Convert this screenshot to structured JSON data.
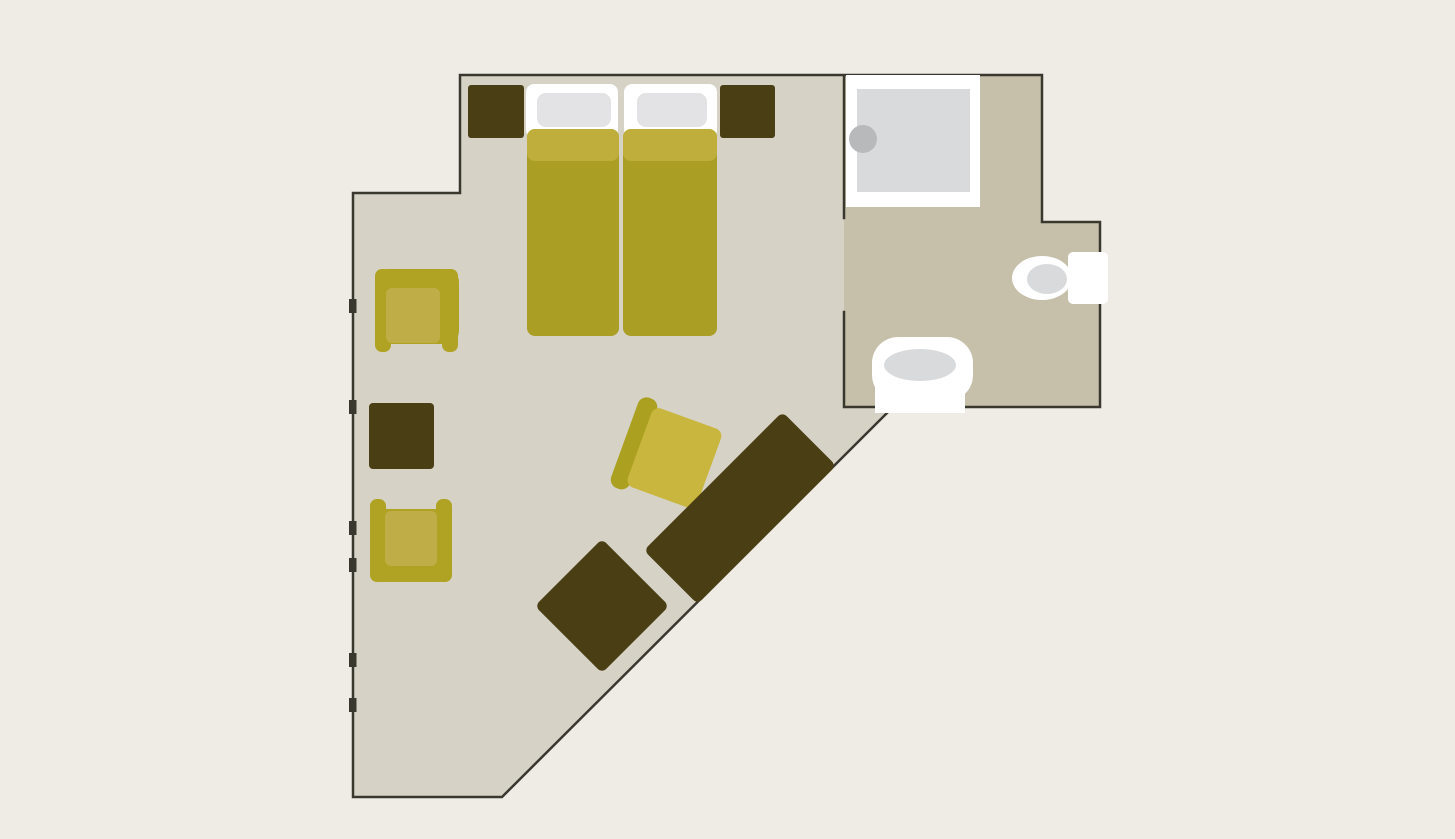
{
  "canvas": {
    "width": 1455,
    "height": 839
  },
  "colors": {
    "background": "#eeece5",
    "room_floor": "#d6d2c6",
    "bathroom_floor": "#c6c0ab",
    "wall": "#3a382e",
    "dark_furniture": "#4a3e14",
    "mustard": "#aa9e24",
    "mustard_light": "#bfae3c",
    "chair_outer": "#b0a323",
    "chair_seat": "#bfae47",
    "chair_band": "#aba01f",
    "chair_seat_bright": "#c9b63e",
    "white": "#ffffff",
    "pillow": "#e3e3e5",
    "fixture_gray": "#d9dadb",
    "drain_gray": "#b8b9bb"
  },
  "shapes": [
    {
      "name": "bedroom-floor",
      "kind": "polygon",
      "fill": "room_floor",
      "attrs": {
        "points": "460,75 844,75 844,407 893,407 502,797 353,797 353,193 460,193"
      }
    },
    {
      "name": "bathroom-floor",
      "kind": "polygon",
      "fill": "bathroom_floor",
      "attrs": {
        "points": "844,75 1042,75 1042,222 1100,222 1100,407 844,407"
      }
    },
    {
      "name": "walls",
      "kind": "path",
      "fill": "none",
      "stroke": "wall",
      "attrs": {
        "d": "M460,75 H1042 M1042,75 V222 H1100 V407 H844 M893,407 L502,797 H353 V193 H460 V75 M844,75 V218 M844,312 V407",
        "stroke-width": "2.5",
        "stroke-linecap": "square"
      }
    },
    {
      "name": "window-tick",
      "kind": "rect",
      "fill": "wall",
      "attrs": {
        "x": "349",
        "y": "299",
        "width": "7.5",
        "height": "14"
      }
    },
    {
      "name": "window-tick",
      "kind": "rect",
      "fill": "wall",
      "attrs": {
        "x": "349",
        "y": "400",
        "width": "7.5",
        "height": "14"
      }
    },
    {
      "name": "window-tick",
      "kind": "rect",
      "fill": "wall",
      "attrs": {
        "x": "349",
        "y": "521",
        "width": "7.5",
        "height": "14"
      }
    },
    {
      "name": "window-tick",
      "kind": "rect",
      "fill": "wall",
      "attrs": {
        "x": "349",
        "y": "558",
        "width": "7.5",
        "height": "14"
      }
    },
    {
      "name": "window-tick",
      "kind": "rect",
      "fill": "wall",
      "attrs": {
        "x": "349",
        "y": "653",
        "width": "7.5",
        "height": "14"
      }
    },
    {
      "name": "window-tick",
      "kind": "rect",
      "fill": "wall",
      "attrs": {
        "x": "349",
        "y": "698",
        "width": "7.5",
        "height": "14"
      }
    },
    {
      "name": "bed-frame-left",
      "kind": "rect",
      "fill": "white",
      "attrs": {
        "x": "526",
        "y": "84",
        "width": "92",
        "height": "54",
        "rx": "8"
      }
    },
    {
      "name": "bed-frame-right",
      "kind": "rect",
      "fill": "white",
      "attrs": {
        "x": "624",
        "y": "84",
        "width": "93",
        "height": "54",
        "rx": "8"
      }
    },
    {
      "name": "pillow-left",
      "kind": "rect",
      "fill": "pillow",
      "attrs": {
        "x": "537",
        "y": "93",
        "width": "74",
        "height": "34",
        "rx": "9"
      }
    },
    {
      "name": "pillow-right",
      "kind": "rect",
      "fill": "pillow",
      "attrs": {
        "x": "637",
        "y": "93",
        "width": "70",
        "height": "34",
        "rx": "9"
      }
    },
    {
      "name": "mattress-left",
      "kind": "rect",
      "fill": "mustard",
      "attrs": {
        "x": "527",
        "y": "129",
        "width": "92",
        "height": "207",
        "rx": "8"
      }
    },
    {
      "name": "mattress-right",
      "kind": "rect",
      "fill": "mustard",
      "attrs": {
        "x": "623",
        "y": "129",
        "width": "94",
        "height": "207",
        "rx": "8"
      }
    },
    {
      "name": "duvet-fold-left",
      "kind": "rect",
      "fill": "mustard_light",
      "attrs": {
        "x": "527",
        "y": "129",
        "width": "92",
        "height": "32",
        "rx": "8"
      }
    },
    {
      "name": "duvet-fold-right",
      "kind": "rect",
      "fill": "mustard_light",
      "attrs": {
        "x": "623",
        "y": "129",
        "width": "94",
        "height": "32",
        "rx": "8"
      }
    },
    {
      "name": "nightstand-left",
      "kind": "rect",
      "fill": "dark_furniture",
      "attrs": {
        "x": "468",
        "y": "85",
        "width": "56",
        "height": "53",
        "rx": "3"
      }
    },
    {
      "name": "nightstand-right",
      "kind": "rect",
      "fill": "dark_furniture",
      "attrs": {
        "x": "720",
        "y": "85",
        "width": "55",
        "height": "53",
        "rx": "3"
      }
    },
    {
      "name": "armchair-top",
      "kind": "group",
      "children": [
        {
          "name": "armchair-back",
          "kind": "rect",
          "fill": "chair_outer",
          "attrs": {
            "x": "375",
            "y": "269",
            "width": "84",
            "height": "75",
            "rx": "13"
          }
        },
        {
          "name": "armchair-arm-left",
          "kind": "rect",
          "fill": "chair_outer",
          "attrs": {
            "x": "375",
            "y": "269",
            "width": "16",
            "height": "83",
            "rx": "7"
          }
        },
        {
          "name": "armchair-arm-right",
          "kind": "rect",
          "fill": "chair_outer",
          "attrs": {
            "x": "442",
            "y": "269",
            "width": "16",
            "height": "83",
            "rx": "7"
          }
        },
        {
          "name": "armchair-seat",
          "kind": "rect",
          "fill": "chair_seat",
          "attrs": {
            "x": "386",
            "y": "288",
            "width": "54",
            "height": "55",
            "rx": "6"
          }
        }
      ]
    },
    {
      "name": "coffee-table",
      "kind": "rect",
      "fill": "dark_furniture",
      "attrs": {
        "x": "369",
        "y": "403",
        "width": "65",
        "height": "66",
        "rx": "4"
      }
    },
    {
      "name": "armchair-bottom",
      "kind": "group",
      "children": [
        {
          "name": "armchair-back",
          "kind": "rect",
          "fill": "chair_outer",
          "attrs": {
            "x": "370",
            "y": "509",
            "width": "82",
            "height": "73",
            "rx": "13"
          }
        },
        {
          "name": "armchair-arm-left",
          "kind": "rect",
          "fill": "chair_outer",
          "attrs": {
            "x": "370",
            "y": "499",
            "width": "16",
            "height": "83",
            "rx": "7"
          }
        },
        {
          "name": "armchair-arm-right",
          "kind": "rect",
          "fill": "chair_outer",
          "attrs": {
            "x": "436",
            "y": "499",
            "width": "16",
            "height": "83",
            "rx": "7"
          }
        },
        {
          "name": "armchair-seat",
          "kind": "rect",
          "fill": "chair_seat",
          "attrs": {
            "x": "385",
            "y": "511",
            "width": "52",
            "height": "55",
            "rx": "6"
          }
        }
      ]
    },
    {
      "name": "lounge-chair",
      "kind": "group",
      "transform": "rotate(20 666 455)",
      "children": [
        {
          "name": "lounge-chair-back",
          "kind": "rect",
          "fill": "chair_band",
          "attrs": {
            "x": "622",
            "y": "407",
            "width": "20",
            "height": "96",
            "rx": "9"
          }
        },
        {
          "name": "lounge-chair-seat",
          "kind": "rect",
          "fill": "chair_seat_bright",
          "attrs": {
            "x": "638",
            "y": "413",
            "width": "74",
            "height": "84",
            "rx": "8"
          }
        }
      ]
    },
    {
      "name": "ottoman",
      "kind": "rect",
      "fill": "dark_furniture",
      "transform": "rotate(45 602 606)",
      "attrs": {
        "x": "554.5",
        "y": "558.5",
        "width": "95",
        "height": "95",
        "rx": "6"
      }
    },
    {
      "name": "sofa",
      "kind": "rect",
      "fill": "dark_furniture",
      "transform": "rotate(-45 740 508)",
      "attrs": {
        "x": "642",
        "y": "470",
        "width": "196",
        "height": "76",
        "rx": "6"
      }
    },
    {
      "name": "shower-tray",
      "kind": "rect",
      "fill": "white",
      "attrs": {
        "x": "846",
        "y": "75",
        "width": "134",
        "height": "132"
      }
    },
    {
      "name": "shower-inner",
      "kind": "rect",
      "fill": "fixture_gray",
      "attrs": {
        "x": "857",
        "y": "89",
        "width": "113",
        "height": "103"
      }
    },
    {
      "name": "shower-drain",
      "kind": "circle",
      "fill": "drain_gray",
      "attrs": {
        "cx": "863",
        "cy": "139",
        "r": "14"
      }
    },
    {
      "name": "toilet-tank",
      "kind": "rect",
      "fill": "white",
      "attrs": {
        "x": "1068",
        "y": "252",
        "width": "40",
        "height": "52",
        "rx": "5"
      }
    },
    {
      "name": "toilet-bowl",
      "kind": "ellipse",
      "fill": "white",
      "attrs": {
        "cx": "1042",
        "cy": "278",
        "rx": "30",
        "ry": "22"
      }
    },
    {
      "name": "toilet-seat",
      "kind": "ellipse",
      "fill": "fixture_gray",
      "attrs": {
        "cx": "1047",
        "cy": "279",
        "rx": "20",
        "ry": "15"
      }
    },
    {
      "name": "sink-pedestal",
      "kind": "rect",
      "fill": "white",
      "attrs": {
        "x": "875",
        "y": "370",
        "width": "90",
        "height": "43"
      }
    },
    {
      "name": "sink-body",
      "kind": "rect",
      "fill": "white",
      "attrs": {
        "x": "872",
        "y": "337",
        "width": "101",
        "height": "64",
        "rx": "26"
      }
    },
    {
      "name": "sink-basin",
      "kind": "ellipse",
      "fill": "fixture_gray",
      "attrs": {
        "cx": "920",
        "cy": "365",
        "rx": "36",
        "ry": "16"
      }
    }
  ]
}
